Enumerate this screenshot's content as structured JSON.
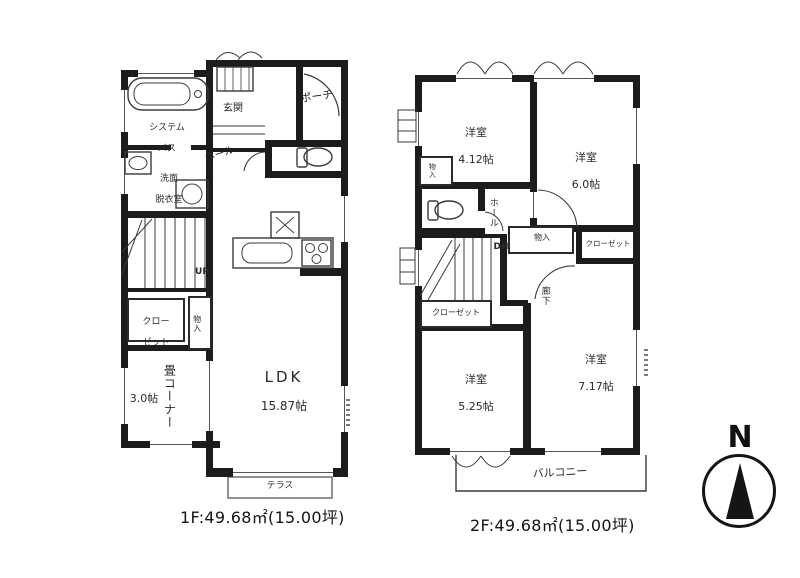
{
  "palette": {
    "wall": "#1c1c1c",
    "background": "#ffffff",
    "line": "#555555"
  },
  "compass": {
    "label": "N"
  },
  "floor1": {
    "caption": "1F:49.68㎡(15.00坪)",
    "bath": {
      "line1": "システム",
      "line2": "バス"
    },
    "washroom": {
      "line1": "洗面",
      "line2": "脱衣室"
    },
    "entrance": "玄関",
    "hall": "ホール",
    "porch": "ポーチ",
    "stairs_label": "UP",
    "closet": {
      "line1": "クロー",
      "line2": "ゼット"
    },
    "storage": "物入",
    "tatami": {
      "name": "畳コーナー",
      "size": "3.0帖"
    },
    "ldk": {
      "name": "LDK",
      "size": "15.87帖"
    },
    "terrace": "テラス"
  },
  "floor2": {
    "caption": "2F:49.68㎡(15.00坪)",
    "room_nw": {
      "name": "洋室",
      "size": "4.12帖"
    },
    "room_ne": {
      "name": "洋室",
      "size": "6.0帖"
    },
    "room_sw": {
      "name": "洋室",
      "size": "5.25帖"
    },
    "room_se": {
      "name": "洋室",
      "size": "7.17帖"
    },
    "storage_left": "物入",
    "hall": "ホール",
    "stairs_label": "DN",
    "storage_mid": "物入",
    "closet_top": "クローゼット",
    "corridor": "廊下",
    "closet_bottom": "クローゼット",
    "balcony": "バルコニー"
  }
}
